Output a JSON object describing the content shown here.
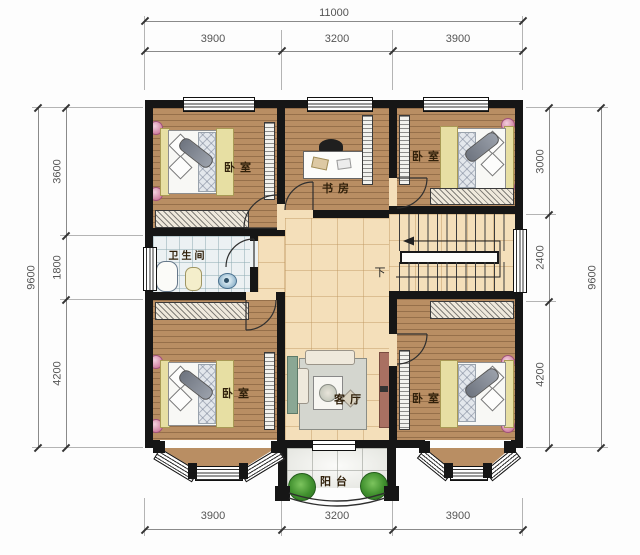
{
  "dimensions": {
    "top": {
      "total": "11000",
      "segments": [
        "3900",
        "3200",
        "3900"
      ]
    },
    "bottom": {
      "segments": [
        "3900",
        "3200",
        "3900"
      ]
    },
    "left": {
      "total": "9600",
      "segments": [
        "3600",
        "1800",
        "4200"
      ]
    },
    "right": {
      "total": "9600",
      "segments": [
        "3000",
        "2400",
        "4200"
      ]
    }
  },
  "rooms": {
    "bedroom_top_left": "卧室",
    "study": "书房",
    "bedroom_top_right": "卧室",
    "bathroom": "卫生间",
    "bedroom_bottom_left": "卧室",
    "living_room": "客厅",
    "bedroom_bottom_right": "卧室",
    "balcony": "阳台",
    "stairs_down": "下"
  },
  "colors": {
    "wall": "#161616",
    "wood_floor": "#b98e63",
    "tile_floor": "#f4dfba",
    "bathroom_floor": "#ecf1f3",
    "balcony_floor": "#eef0ec",
    "dimension_text": "#555555",
    "label_text": "#30200a",
    "plant_green": "#3f8f2d",
    "accent_pink": "#c4648c"
  }
}
